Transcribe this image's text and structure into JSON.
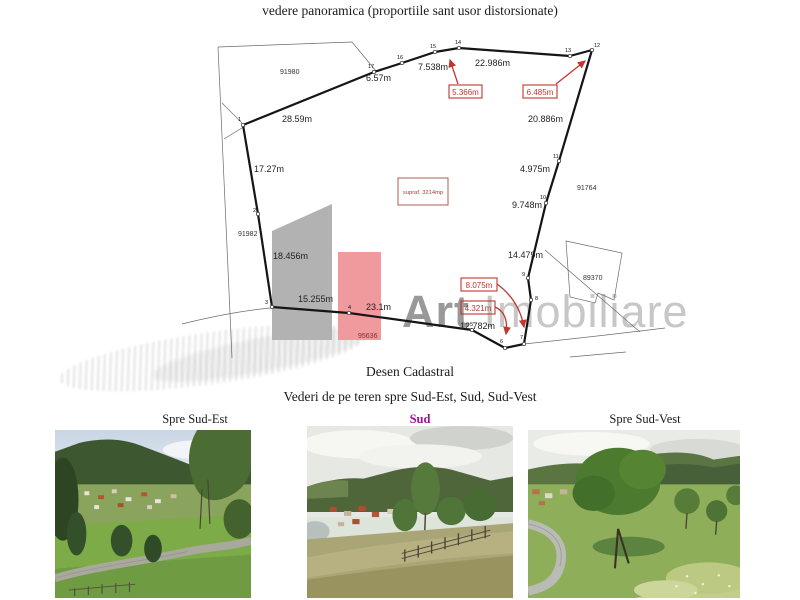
{
  "page": {
    "title": "vedere panoramica (proportiile sant usor distorsionate)",
    "drawing_caption": "Desen Cadastral",
    "photos_caption": "Vederi de pe teren spre Sud-Est, Sud, Sud-Vest"
  },
  "drawing": {
    "area_box": "supraf. 3214mp",
    "watermark_bold": "Art",
    "watermark_light": "Imobiliare",
    "segments": [
      "28.59m",
      "17.27m",
      "18.456m",
      "15.255m",
      "23.1m",
      "12.782m",
      "14.479m",
      "9.748m",
      "4.975m",
      "20.886m",
      "22.986m",
      "7.538m",
      "6.57m"
    ],
    "red_boxes": [
      "5.366m",
      "6.485m",
      "8.075m",
      "4.321m"
    ],
    "points": [
      "1",
      "2",
      "3",
      "4",
      "5",
      "6",
      "7",
      "8",
      "9",
      "10",
      "11",
      "12",
      "13",
      "14",
      "15",
      "16",
      "17"
    ],
    "parcels": [
      "91980",
      "91982",
      "91764",
      "89370",
      "95636"
    ]
  },
  "photos": [
    {
      "label": "Spre Sud-Est"
    },
    {
      "label": "Sud"
    },
    {
      "label": "Spre Sud-Vest"
    }
  ],
  "colors": {
    "accent_red": "#c2362e",
    "pink_shape": "#f19a9d",
    "gray_shape": "#b2b2b2",
    "magenta_label": "#a0109c",
    "watermark_dark": "#999999",
    "watermark_light": "#c7c7c7"
  }
}
